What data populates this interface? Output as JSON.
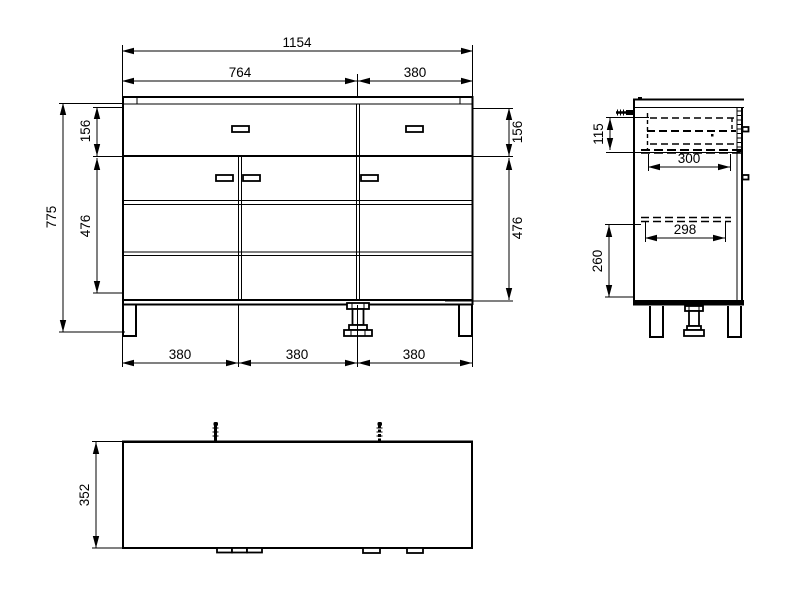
{
  "front_view": {
    "labels": {
      "total_width": "1154",
      "left_section_width": "764",
      "right_section_width": "380",
      "total_height": "775",
      "top_drawer_height_left": "156",
      "lower_section_height_left": "476",
      "top_drawer_height_right": "156",
      "lower_section_height_right": "476",
      "bottom_span_left": "380",
      "bottom_span_middle": "380",
      "bottom_span_right": "380"
    }
  },
  "side_view": {
    "labels": {
      "top_drawer_inner_height": "115",
      "top_drawer_depth": "300",
      "shelf_depth": "298",
      "lower_section_height": "260"
    }
  },
  "plan_view": {
    "labels": {
      "depth": "352"
    }
  },
  "colors": {
    "line_color": "#000000",
    "background": "#ffffff"
  }
}
